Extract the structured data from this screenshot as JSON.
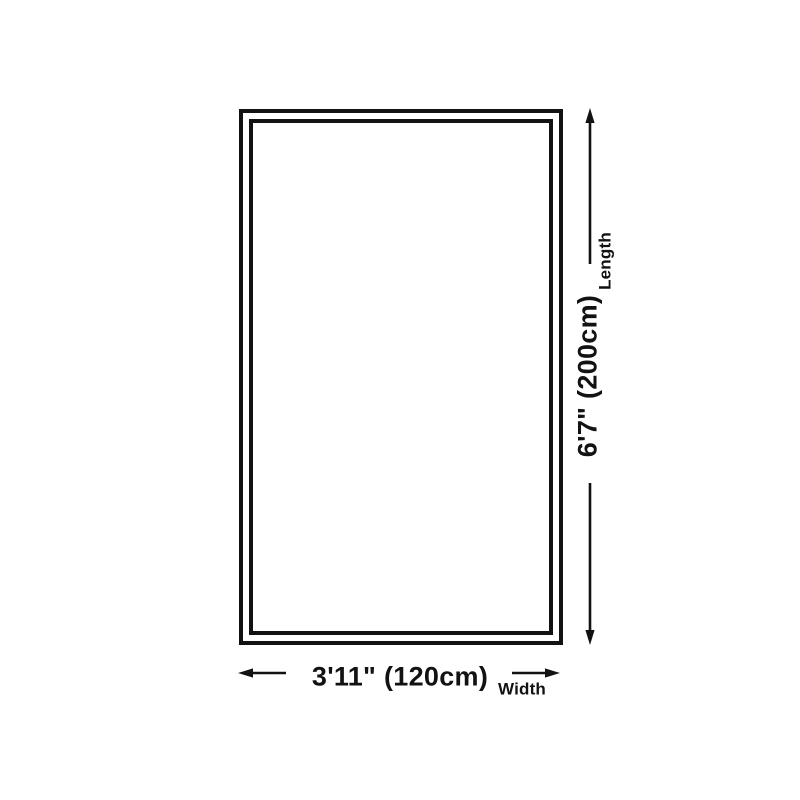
{
  "theme": {
    "bg": "#ffffff",
    "ink": "#121212"
  },
  "diagram": {
    "length": {
      "value": "6'7\" (200cm)",
      "label": "Length"
    },
    "width": {
      "value": "3'11\" (120cm)",
      "label": "Width"
    }
  }
}
